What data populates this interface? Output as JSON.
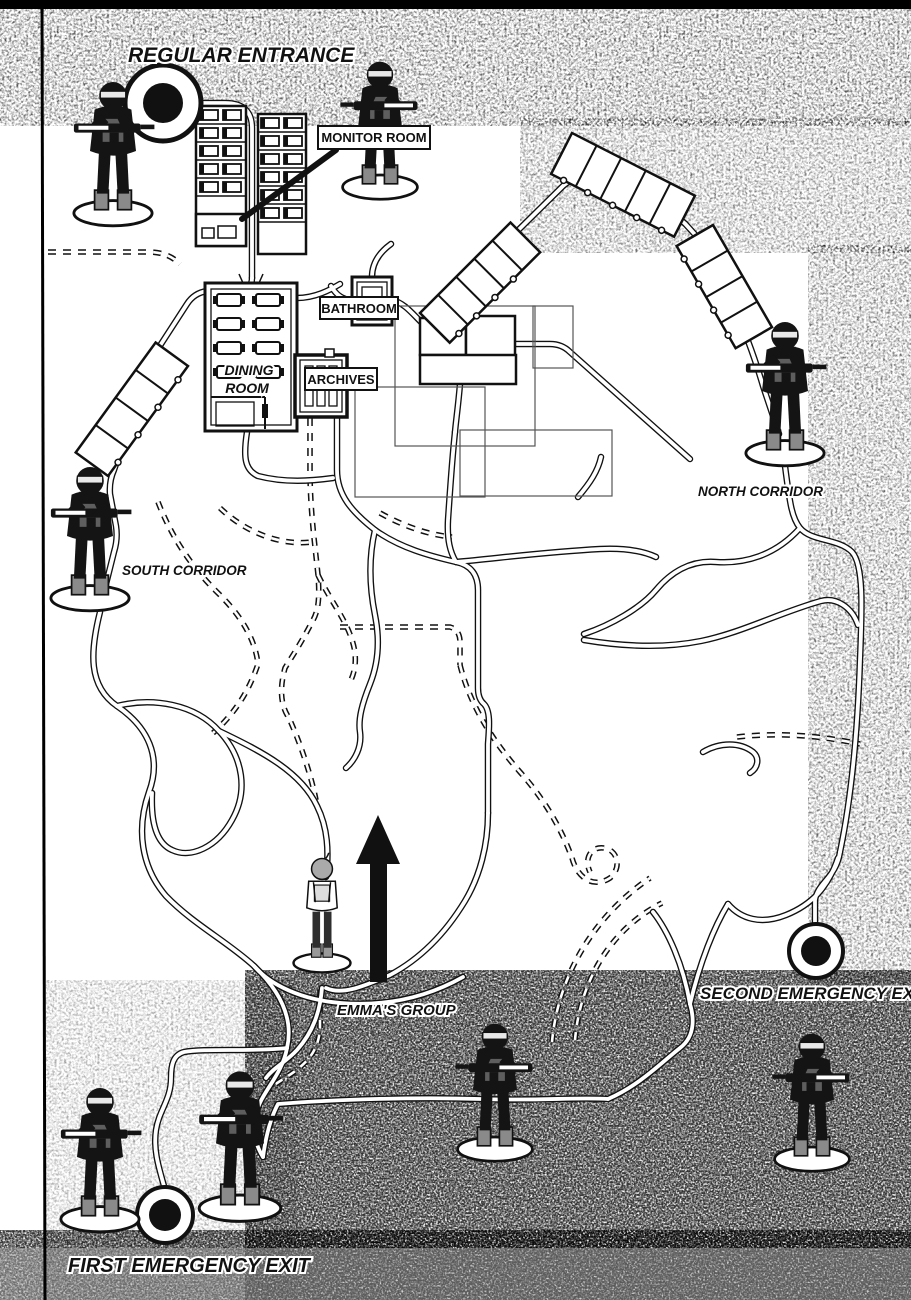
{
  "map": {
    "title_area": {},
    "labels": {
      "regular_entrance": "REGULAR ENTRANCE",
      "monitor_room": "MONITOR ROOM",
      "bathroom": "BATHROOM",
      "dining_room": {
        "line1": "DINING",
        "line2": "ROOM"
      },
      "archives": "ARCHIVES",
      "north_corridor": "NORTH CORRIDOR",
      "south_corridor": "SOUTH CORRIDOR",
      "emmas_group": "EMMA'S GROUP",
      "first_emergency_exit": "FIRST EMERGENCY EXIT",
      "second_emergency_exit": "SECOND EMERGENCY EXIT"
    },
    "colors": {
      "ink": "#111111",
      "paper": "#ffffff",
      "tone": "#9a9a9a"
    },
    "figures": [
      "guard-at-regular-entrance",
      "guard-at-monitor-room",
      "guard-at-north-corridor",
      "guard-at-south-corridor",
      "emma",
      "guard-bottom-center",
      "guard-near-first-exit-left",
      "guard-near-first-exit-right",
      "guard-at-second-exit"
    ],
    "markers": {
      "regular_entrance": "double-circle",
      "first_emergency_exit": "double-circle",
      "second_emergency_exit": "double-circle"
    }
  }
}
